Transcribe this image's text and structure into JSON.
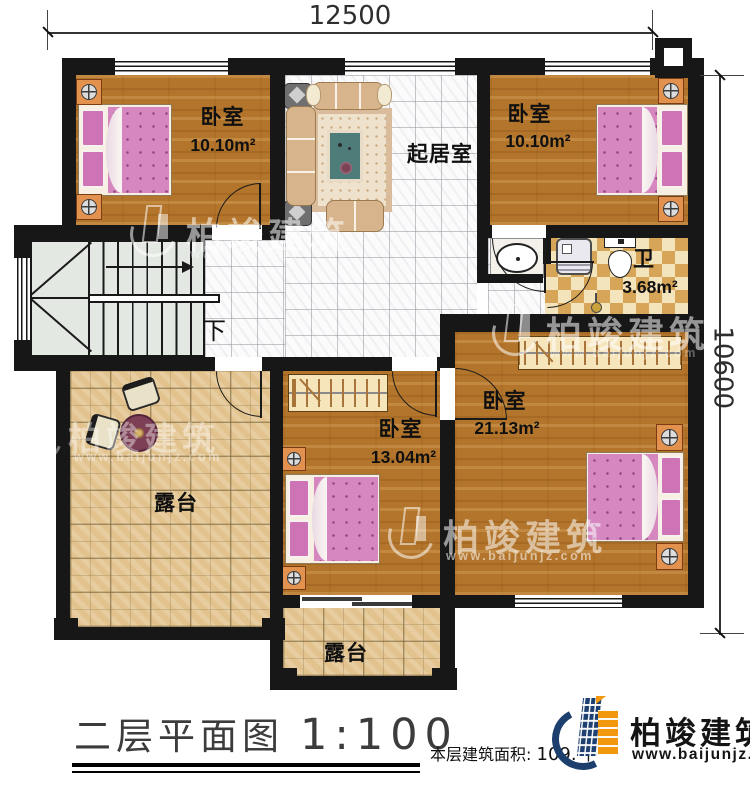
{
  "plan": {
    "title": "二层平面图",
    "scale": "1:100",
    "floor_area_label": "本层建筑面积:",
    "floor_area_value": "109.",
    "floor_area_unit_partial": "平",
    "dimensions": {
      "width_mm": "12500",
      "height_mm": "10600"
    }
  },
  "rooms": {
    "bedroom_top_left": {
      "name": "卧室",
      "area": "10.10m²"
    },
    "bedroom_top_right": {
      "name": "卧室",
      "area": "10.10m²"
    },
    "living_room": {
      "name": "起居室"
    },
    "bathroom": {
      "name": "卫",
      "area": "3.68m²"
    },
    "bedroom_mid": {
      "name": "卧室",
      "area": "13.04m²"
    },
    "bedroom_right": {
      "name": "卧室",
      "area": "21.13m²"
    },
    "terrace_left": {
      "name": "露台"
    },
    "terrace_bottom": {
      "name": "露台"
    },
    "stairs": {
      "down_label": "下"
    }
  },
  "brand": {
    "name": "柏竣建筑",
    "url": "www.baijunjz.com"
  },
  "watermark": {
    "name": "柏竣建筑",
    "url": "www.baijunjz.com"
  },
  "colors": {
    "wall": "#171717",
    "wood_floor": "#b3752c",
    "terrace_tile": "#e2c38e",
    "bath_checker": "#d7a558",
    "bed_pink": "#d687c0",
    "brand_navy": "#1c3f6e",
    "brand_orange": "#f2980f"
  }
}
